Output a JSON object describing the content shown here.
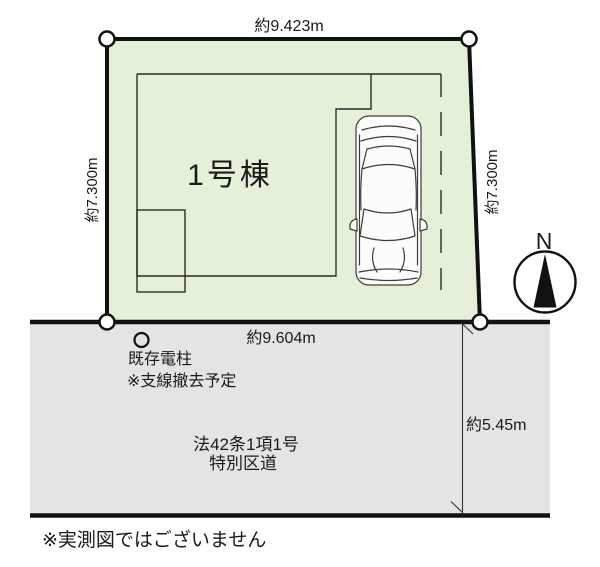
{
  "site_plan": {
    "building_label": "1号棟",
    "dimensions": {
      "top": "約9.423m",
      "left": "約7.300m",
      "right": "約7.300m",
      "frontage": "約9.604m",
      "road_width": "約5.45m"
    },
    "utility_pole": {
      "label": "既存電柱",
      "note": "※支線撤去予定"
    },
    "road": {
      "classification": "法42条1項1号",
      "type": "特別区道"
    },
    "compass": {
      "label": "N"
    },
    "disclaimer": "※実測図ではございません",
    "colors": {
      "lot_fill": "#e4f0d8",
      "road_fill": "#e4e4e4",
      "line": "#111111"
    }
  }
}
